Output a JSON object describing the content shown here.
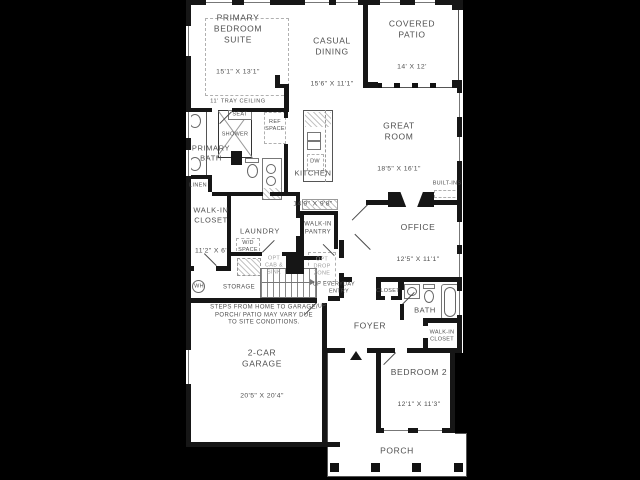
{
  "colors": {
    "canvas": "#000000",
    "floor": "#ffffff",
    "wall": "#161616",
    "text": "#4f4f4f",
    "muted": "#9e9e9e"
  },
  "rooms": {
    "primary_bedroom": {
      "name": "PRIMARY\nBEDROOM\nSUITE",
      "dims": "15'1\" X 13'1\"",
      "note": "11' TRAY CEILING"
    },
    "casual_dining": {
      "name": "CASUAL\nDINING",
      "dims": "15'6\" X 11'1\""
    },
    "covered_patio": {
      "name": "COVERED\nPATIO",
      "dims": "14' X 12'"
    },
    "great_room": {
      "name": "GREAT\nROOM",
      "dims": "18'5\" X 16'1\""
    },
    "primary_bath": {
      "name": "PRIMARY\nBATH"
    },
    "kitchen": {
      "name": "KITCHEN",
      "dims": "14'9\" X 9'8\""
    },
    "walk_in_closet": {
      "name": "WALK-IN\nCLOSET",
      "dims": "11'2\" X 6'"
    },
    "laundry": {
      "name": "LAUNDRY"
    },
    "walk_in_pantry": {
      "name": "WALK-IN\nPANTRY"
    },
    "office": {
      "name": "OFFICE",
      "dims": "12'5\" X 11'1\""
    },
    "storage": {
      "name": "STORAGE"
    },
    "everyday_entry": {
      "name": "EVERYDAY\nENTRY"
    },
    "foyer": {
      "name": "FOYER"
    },
    "closet": {
      "name": "CLOSET"
    },
    "bath": {
      "name": "BATH"
    },
    "walk_in_closet_2": {
      "name": "WALK-IN\nCLOSET"
    },
    "bedroom_2": {
      "name": "BEDROOM 2",
      "dims": "12'1\" X 11'3\""
    },
    "garage": {
      "name": "2-CAR\nGARAGE",
      "dims": "20'5\" X 20'4\""
    },
    "porch": {
      "name": "PORCH"
    }
  },
  "features": {
    "seat": "SEAT",
    "shower": "SHOWER",
    "ref_space": "REF\nSPACE",
    "linen": "LINEN",
    "dw": "DW",
    "built_ins": "BUILT-INS",
    "wd_space": "W/D\nSPACE",
    "opt_cab_sink": "OPT\nCAB &\nSINK",
    "opt_drop_zone": "OPT\nDROP\nZONE",
    "wh": "WH",
    "up_stairs": "UP",
    "up_entry": "UP"
  },
  "disclaimer": "STEPS FROM HOME TO GARAGE/\nPORCH/ PATIO MAY VARY DUE\nTO SITE CONDITIONS."
}
